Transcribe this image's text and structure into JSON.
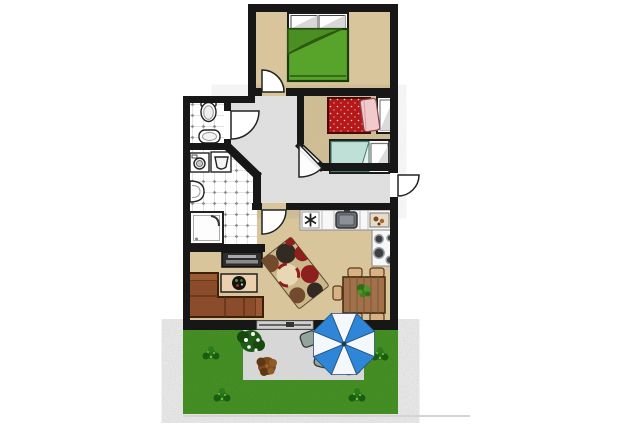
{
  "canvas": {
    "width": 640,
    "height": 427,
    "background": "#ffffff"
  },
  "scene": {
    "type": "apartment-floor-plan-with-garden",
    "rooms": [
      {
        "id": "bedroom-1",
        "furniture": [
          "double-bed-green",
          "door"
        ]
      },
      {
        "id": "bedroom-2",
        "furniture": [
          "double-bed-red",
          "single-bed-mint",
          "door-on-diagonal-wall"
        ]
      },
      {
        "id": "wc",
        "furniture": [
          "toilet",
          "hand-basin",
          "door"
        ]
      },
      {
        "id": "bathroom",
        "furniture": [
          "washing-machine",
          "laundry-basin",
          "wall-sink",
          "shower"
        ]
      },
      {
        "id": "hallway",
        "furniture": [
          "entrance-door"
        ]
      },
      {
        "id": "living-room",
        "furniture": [
          "corner-sofa",
          "tv-stand",
          "coffee-table",
          "area-rug",
          "dining-table",
          "dining-chairs",
          "sliding-terrace-door"
        ]
      },
      {
        "id": "kitchen",
        "furniture": [
          "counter",
          "hob-symbol",
          "kitchen-sink",
          "cutting-board",
          "stove-4-burners"
        ]
      },
      {
        "id": "garden",
        "furniture": [
          "lawn",
          "patio",
          "parasol",
          "patio-chairs",
          "flowering-bush",
          "brown-shrub",
          "lawn-bushes"
        ]
      }
    ],
    "counts": {
      "dining_chairs": 5,
      "patio_chairs": 4,
      "lawn_bushes": 4,
      "parasol_segments": 8
    }
  },
  "colors": {
    "background": "#ffffff",
    "wall": "#171717",
    "floor_tan": "#d8c59c",
    "hallway": "#e9e9e9",
    "tile_white": "#ffffff",
    "bed_green": "#58a42a",
    "bed_green_dark": "#4b8f22",
    "bed_red": "#b51818",
    "pillow_pink": "#f2c9cd",
    "bed_mint": "#bfe0d6",
    "sofa_brown": "#8a4c2a",
    "table_wood": "#a0714a",
    "chair_tan": "#d8b285",
    "rug_base": "#cbb78a",
    "rug_red": "#8e1f1c",
    "rug_brown": "#734a2e",
    "rug_dark": "#332a24",
    "rug_cream": "#e7d7b4",
    "counter_white": "#f7f7f7",
    "sink_gray": "#6a6f74",
    "stand_dark": "#2e2e2e",
    "coffee_table": "#eccfae",
    "plant_green": "#3f7d1f",
    "lawn_green": "#4c9e28",
    "patio_gray": "#d7d7d7",
    "umbrella_blue": "#2f85d6",
    "umbrella_white": "#f5f8fa",
    "chair_gray": "#95a39b",
    "bush_green": "#256e18",
    "shrub_brown": "#7a4a1e",
    "shadow_line": "#d4d4d4"
  }
}
